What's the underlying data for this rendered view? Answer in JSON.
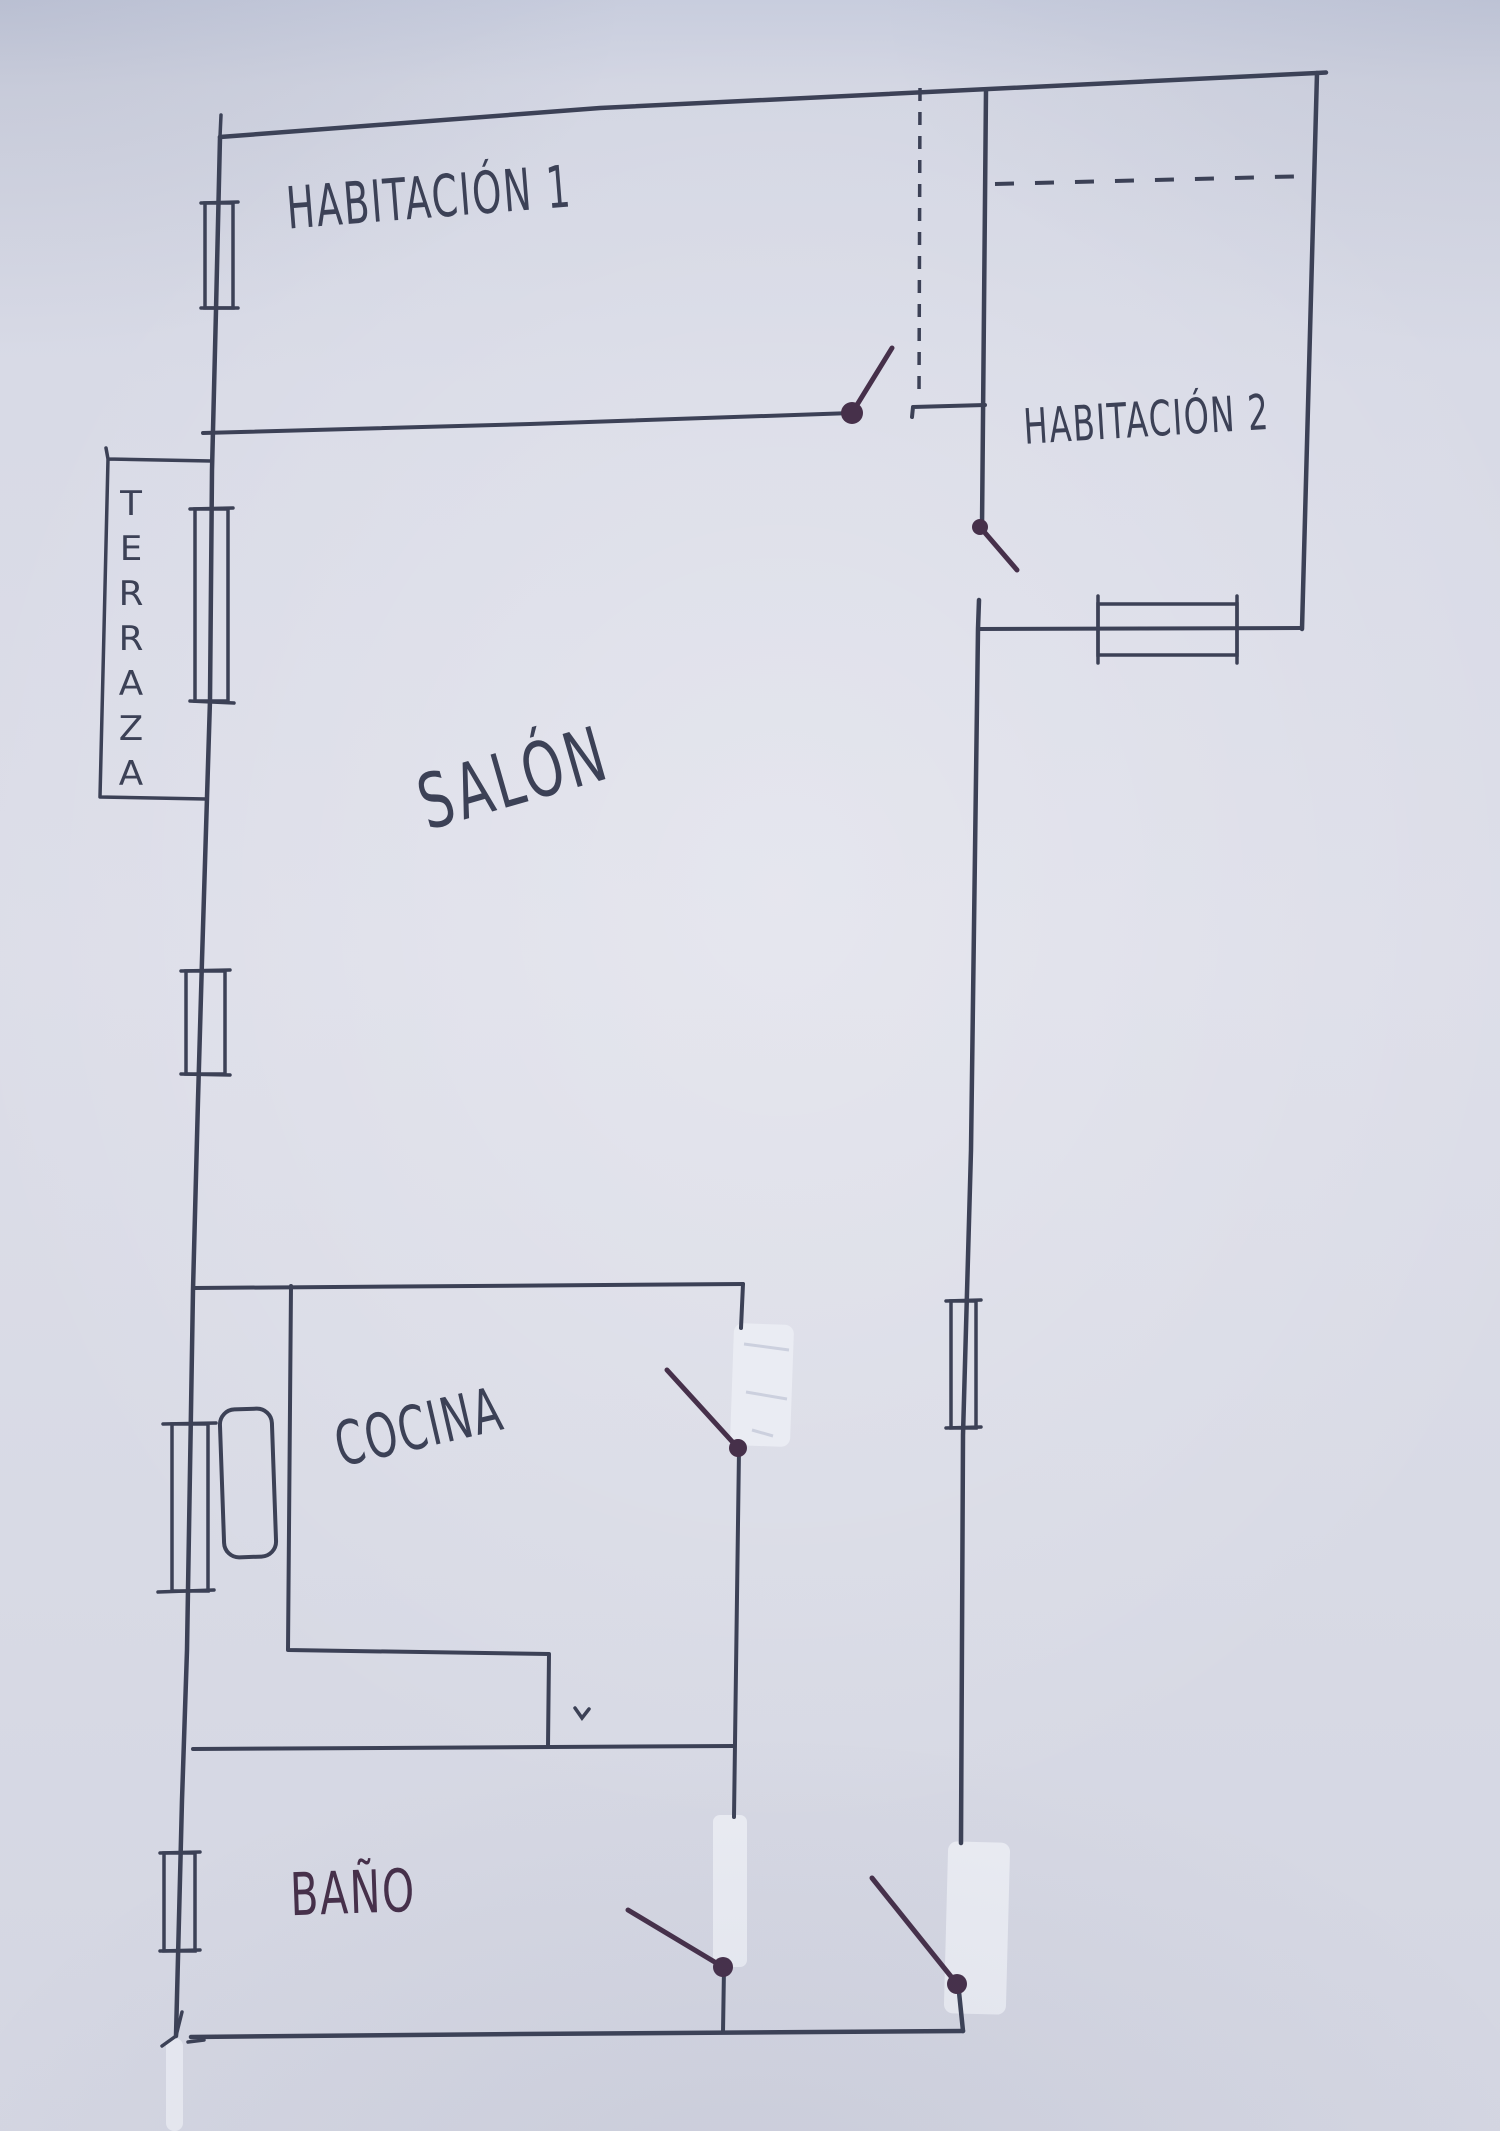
{
  "colors": {
    "paper": "#d6d8e4",
    "ink": "#3c4156",
    "door_ink": "#46304a",
    "whiteout": "#eaecf3"
  },
  "rooms": {
    "habitacion1": {
      "label": "HABITACIÓN 1"
    },
    "habitacion2": {
      "label": "HABITACIÓN 2"
    },
    "salon": {
      "label": "SALÓN"
    },
    "terraza": {
      "label": "TERRAZA"
    },
    "cocina": {
      "label": "COCINA"
    },
    "bano": {
      "label": "BAÑO"
    }
  }
}
